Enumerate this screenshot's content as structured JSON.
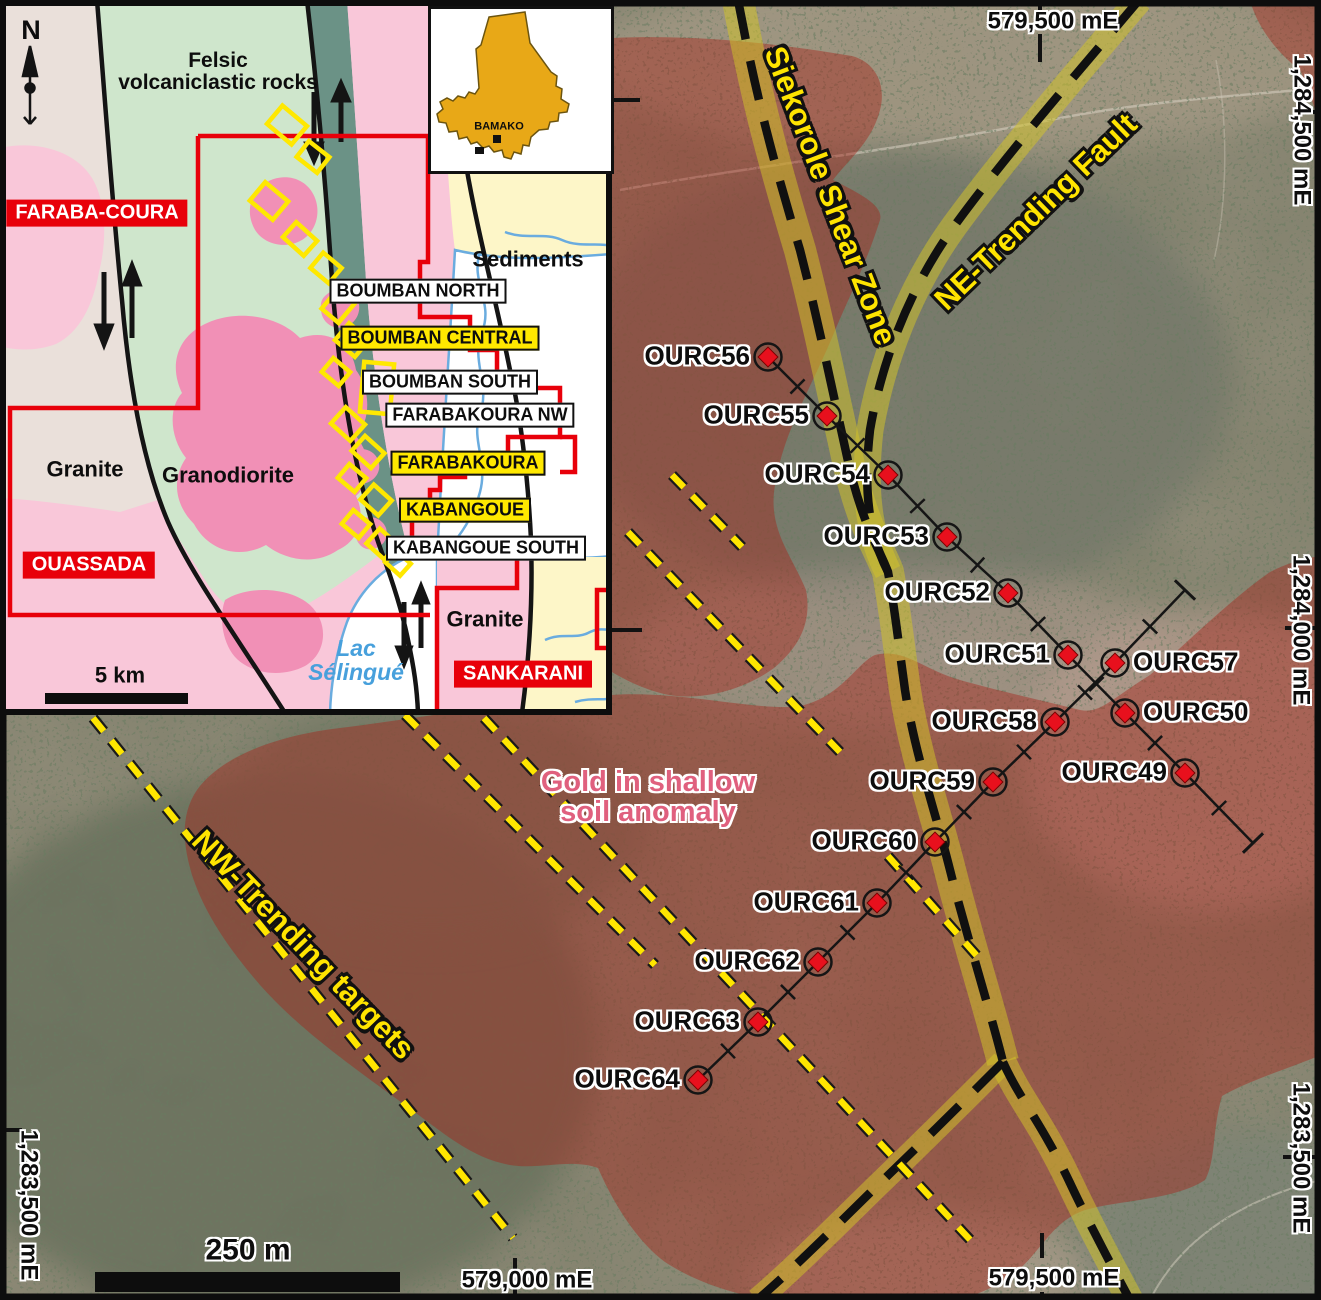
{
  "figure": {
    "kind": "exploration-map",
    "country_label": "BAMAKO",
    "north_label": "N"
  },
  "colors": {
    "anomaly_overlay": "#a61e16",
    "shear_band_yellow": "#d2c428",
    "target_dash_yellow": "#ffe600",
    "annotation_yellow": "#ffe400",
    "anomaly_text_pink": "#e0607e",
    "permit_red": "#e8000a",
    "drill_marker_red": "#e8101d",
    "lake_blue": "#6aacdf",
    "mali_gold": "#e8a817"
  },
  "inset": {
    "scale_text": "5 km",
    "labels": [
      {
        "id": "north-label",
        "text": "N",
        "x": 31,
        "y": 30,
        "cls": "north"
      },
      {
        "id": "felsic-volcaniclastic-label",
        "text": "Felsic\nvolcaniclastic rocks",
        "x": 218,
        "y": 72,
        "cls": "geo"
      },
      {
        "id": "sediments-label",
        "text": "Sediments",
        "x": 528,
        "y": 260,
        "cls": "geo-big"
      },
      {
        "id": "granite-west-label",
        "text": "Granite",
        "x": 85,
        "y": 470,
        "cls": "geo-big"
      },
      {
        "id": "granodiorite-label",
        "text": "Granodiorite",
        "x": 228,
        "y": 476,
        "cls": "geo-big"
      },
      {
        "id": "granite-southeast-label",
        "text": "Granite",
        "x": 485,
        "y": 620,
        "cls": "geo-big"
      },
      {
        "id": "lac-selingue-label",
        "text": "Lac\nSélingué",
        "x": 356,
        "y": 661,
        "cls": "lake"
      },
      {
        "id": "inset-scale-text",
        "text": "5 km",
        "x": 120,
        "y": 676,
        "cls": "geo-big"
      },
      {
        "id": "permit-faraba-coura",
        "text": "FARABA-COURA",
        "x": 97,
        "y": 213,
        "cls": "box-red"
      },
      {
        "id": "permit-ouassada",
        "text": "OUASSADA",
        "x": 89,
        "y": 565,
        "cls": "box-red"
      },
      {
        "id": "permit-sankarani",
        "text": "SANKARANI",
        "x": 523,
        "y": 674,
        "cls": "box-red"
      },
      {
        "id": "prospect-boumban-north",
        "text": "BOUMBAN NORTH",
        "x": 418,
        "y": 291,
        "cls": "box-white"
      },
      {
        "id": "prospect-boumban-central",
        "text": "BOUMBAN CENTRAL",
        "x": 440,
        "y": 338,
        "cls": "box-yellow"
      },
      {
        "id": "prospect-boumban-south",
        "text": "BOUMBAN SOUTH",
        "x": 450,
        "y": 382,
        "cls": "box-white"
      },
      {
        "id": "prospect-farabakoura-nw",
        "text": "FARABAKOURA NW",
        "x": 480,
        "y": 415,
        "cls": "box-white"
      },
      {
        "id": "prospect-farabakoura",
        "text": "FARABAKOURA",
        "x": 468,
        "y": 463,
        "cls": "box-yellow"
      },
      {
        "id": "prospect-kabangoue",
        "text": "KABANGOUE",
        "x": 465,
        "y": 510,
        "cls": "box-yellow"
      },
      {
        "id": "prospect-kabangoue-south",
        "text": "KABANGOUE SOUTH",
        "x": 486,
        "y": 548,
        "cls": "box-white"
      }
    ],
    "mali_labels": [
      {
        "id": "bamako-label",
        "text": "BAMAKO",
        "x": 68,
        "y": 118,
        "cls": "bamako"
      }
    ]
  },
  "map": {
    "scale_text": "250 m",
    "labels": [
      {
        "id": "grid-top-579500",
        "text": "579,500 mE",
        "x": 1053,
        "y": 22,
        "cls": "grid"
      },
      {
        "id": "grid-right-1284500",
        "text": "1,284,500 mE",
        "x": 1301,
        "y": 130,
        "rot": 90,
        "cls": "grid"
      },
      {
        "id": "grid-right-1284000",
        "text": "1,284,000 mE",
        "x": 1300,
        "y": 630,
        "rot": 90,
        "cls": "grid"
      },
      {
        "id": "grid-right-1283500",
        "text": "1,283,500 mE",
        "x": 1300,
        "y": 1158,
        "rot": 90,
        "cls": "grid"
      },
      {
        "id": "grid-left-1283500",
        "text": "1,283,500 mE",
        "x": 28,
        "y": 1205,
        "rot": 90,
        "cls": "grid"
      },
      {
        "id": "grid-bottom-579000",
        "text": "579,000 mE",
        "x": 527,
        "y": 1281,
        "cls": "grid"
      },
      {
        "id": "grid-bottom-579500",
        "text": "579,500 mE",
        "x": 1054,
        "y": 1279,
        "cls": "grid"
      },
      {
        "id": "siekorole-shear-zone-label",
        "text": "Siekorole Shear Zone",
        "x": 830,
        "y": 196,
        "rot": 69,
        "cls": "fault-ann"
      },
      {
        "id": "ne-trending-fault-label",
        "text": "NE-Trending Fault",
        "x": 1036,
        "y": 212,
        "rot": -44,
        "cls": "fault-ann"
      },
      {
        "id": "nw-trending-targets-label",
        "text": "NW-Trending targets",
        "x": 303,
        "y": 945,
        "rot": 46,
        "cls": "fault-ann"
      },
      {
        "id": "gold-anomaly-label",
        "text": "Gold in shallow\nsoil anomaly",
        "x": 648,
        "y": 797,
        "cls": "gold"
      },
      {
        "id": "map-scale-text",
        "text": "250 m",
        "x": 248,
        "y": 1250,
        "cls": "scale"
      }
    ],
    "drillholes": [
      {
        "name": "OURC56",
        "x": 768,
        "y": 357,
        "side": "left"
      },
      {
        "name": "OURC55",
        "x": 827,
        "y": 416,
        "side": "left"
      },
      {
        "name": "OURC54",
        "x": 888,
        "y": 475,
        "side": "left"
      },
      {
        "name": "OURC53",
        "x": 947,
        "y": 537,
        "side": "left"
      },
      {
        "name": "OURC52",
        "x": 1008,
        "y": 593,
        "side": "left"
      },
      {
        "name": "OURC51",
        "x": 1068,
        "y": 655,
        "side": "left"
      },
      {
        "name": "OURC50",
        "x": 1125,
        "y": 713,
        "side": "right"
      },
      {
        "name": "OURC49",
        "x": 1185,
        "y": 773,
        "side": "left"
      },
      {
        "name": "OURC57",
        "x": 1115,
        "y": 663,
        "side": "right"
      },
      {
        "name": "OURC58",
        "x": 1055,
        "y": 722,
        "side": "left"
      },
      {
        "name": "OURC59",
        "x": 993,
        "y": 782,
        "side": "left"
      },
      {
        "name": "OURC60",
        "x": 935,
        "y": 842,
        "side": "left"
      },
      {
        "name": "OURC61",
        "x": 877,
        "y": 903,
        "side": "left"
      },
      {
        "name": "OURC62",
        "x": 818,
        "y": 962,
        "side": "left"
      },
      {
        "name": "OURC63",
        "x": 758,
        "y": 1022,
        "side": "left"
      },
      {
        "name": "OURC64",
        "x": 698,
        "y": 1080,
        "side": "left"
      }
    ],
    "traverses": [
      {
        "id": "traverse-nw-se",
        "points": [
          "OURC56",
          "OURC55",
          "OURC54",
          "OURC53",
          "OURC52",
          "OURC51",
          "OURC50",
          "OURC49",
          {
            "x": 1253,
            "y": 843
          }
        ],
        "end_tick": "last"
      },
      {
        "id": "traverse-ne-sw",
        "points": [
          {
            "x": 1185,
            "y": 590
          },
          "OURC57",
          "OURC58",
          "OURC59",
          "OURC60",
          "OURC61",
          "OURC62",
          "OURC63",
          "OURC64"
        ],
        "end_tick": "first"
      }
    ]
  }
}
